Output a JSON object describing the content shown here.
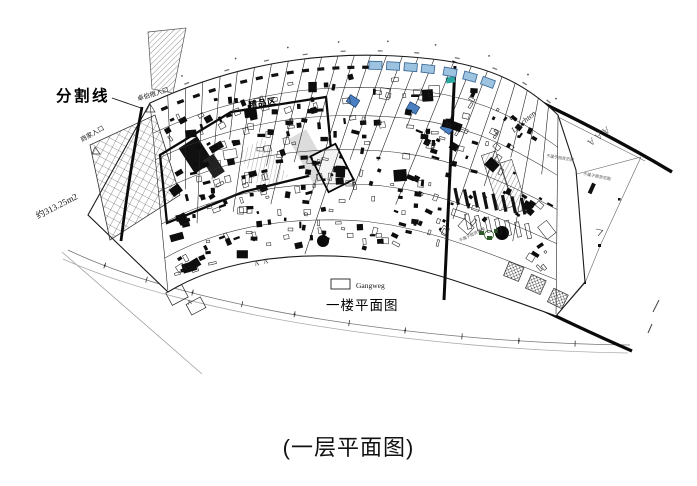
{
  "page": {
    "background": "#ffffff",
    "caption": "(一层平面图)"
  },
  "plan": {
    "labels": {
      "divider_line": "分割线",
      "entrance_zhuobogen": "卓伯根入口",
      "entrance_merchant": "商家入口",
      "area_note": "约313.25m2",
      "boutique_zone": "精品区",
      "leuchten": "Leuchten",
      "survey_marks": "AAA",
      "annotation_right_top": "不属于租赁范围",
      "annotation_right_mid": "不属于租赁范围",
      "annotation_bottom": "不属于租赁范围",
      "section_mark_1": "A",
      "section_mark_2": "A",
      "section_mark_3": "A"
    },
    "legend": {
      "swatch_label": "Gangweg",
      "plan_title": "一楼平面图"
    },
    "colors": {
      "line": "#1a1a1a",
      "light_line": "#555555",
      "window_blue": "#9cc3e0",
      "window_border": "#33618f",
      "furniture_blue": "#4a7fc1",
      "teal_accent": "#2aa7a0",
      "plant_green": "#2d5a27"
    }
  }
}
